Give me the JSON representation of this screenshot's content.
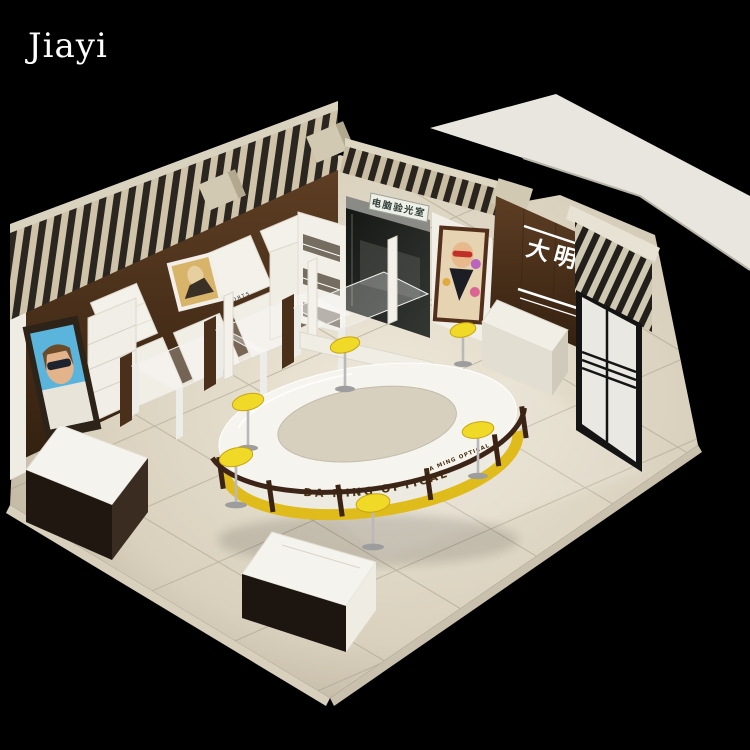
{
  "watermark": {
    "text": "Jiayi"
  },
  "scene": {
    "description": "Isometric 3D rendering of an eyewear shop interior (DA MING OPTICAL) on a black background",
    "signs": {
      "optometry_room": "电脑验光室",
      "brand_wall": "大明",
      "counter_band": "DA MING   OPTICAL",
      "counter_band_side": "DA MING  OPTICAL",
      "display_panel_brand": "PORTS"
    },
    "colors": {
      "background": "#000000",
      "floor_light": "#ece5d4",
      "floor_dark": "#b0a691",
      "wood_dark": "#4a2f1b",
      "stripe_light": "#cfc4aa",
      "stripe_dark": "#2b2620",
      "counter_band_yellow": "#e0bb1c",
      "stool_yellow": "#f0da27",
      "surface_white": "#f4f2ec"
    }
  }
}
